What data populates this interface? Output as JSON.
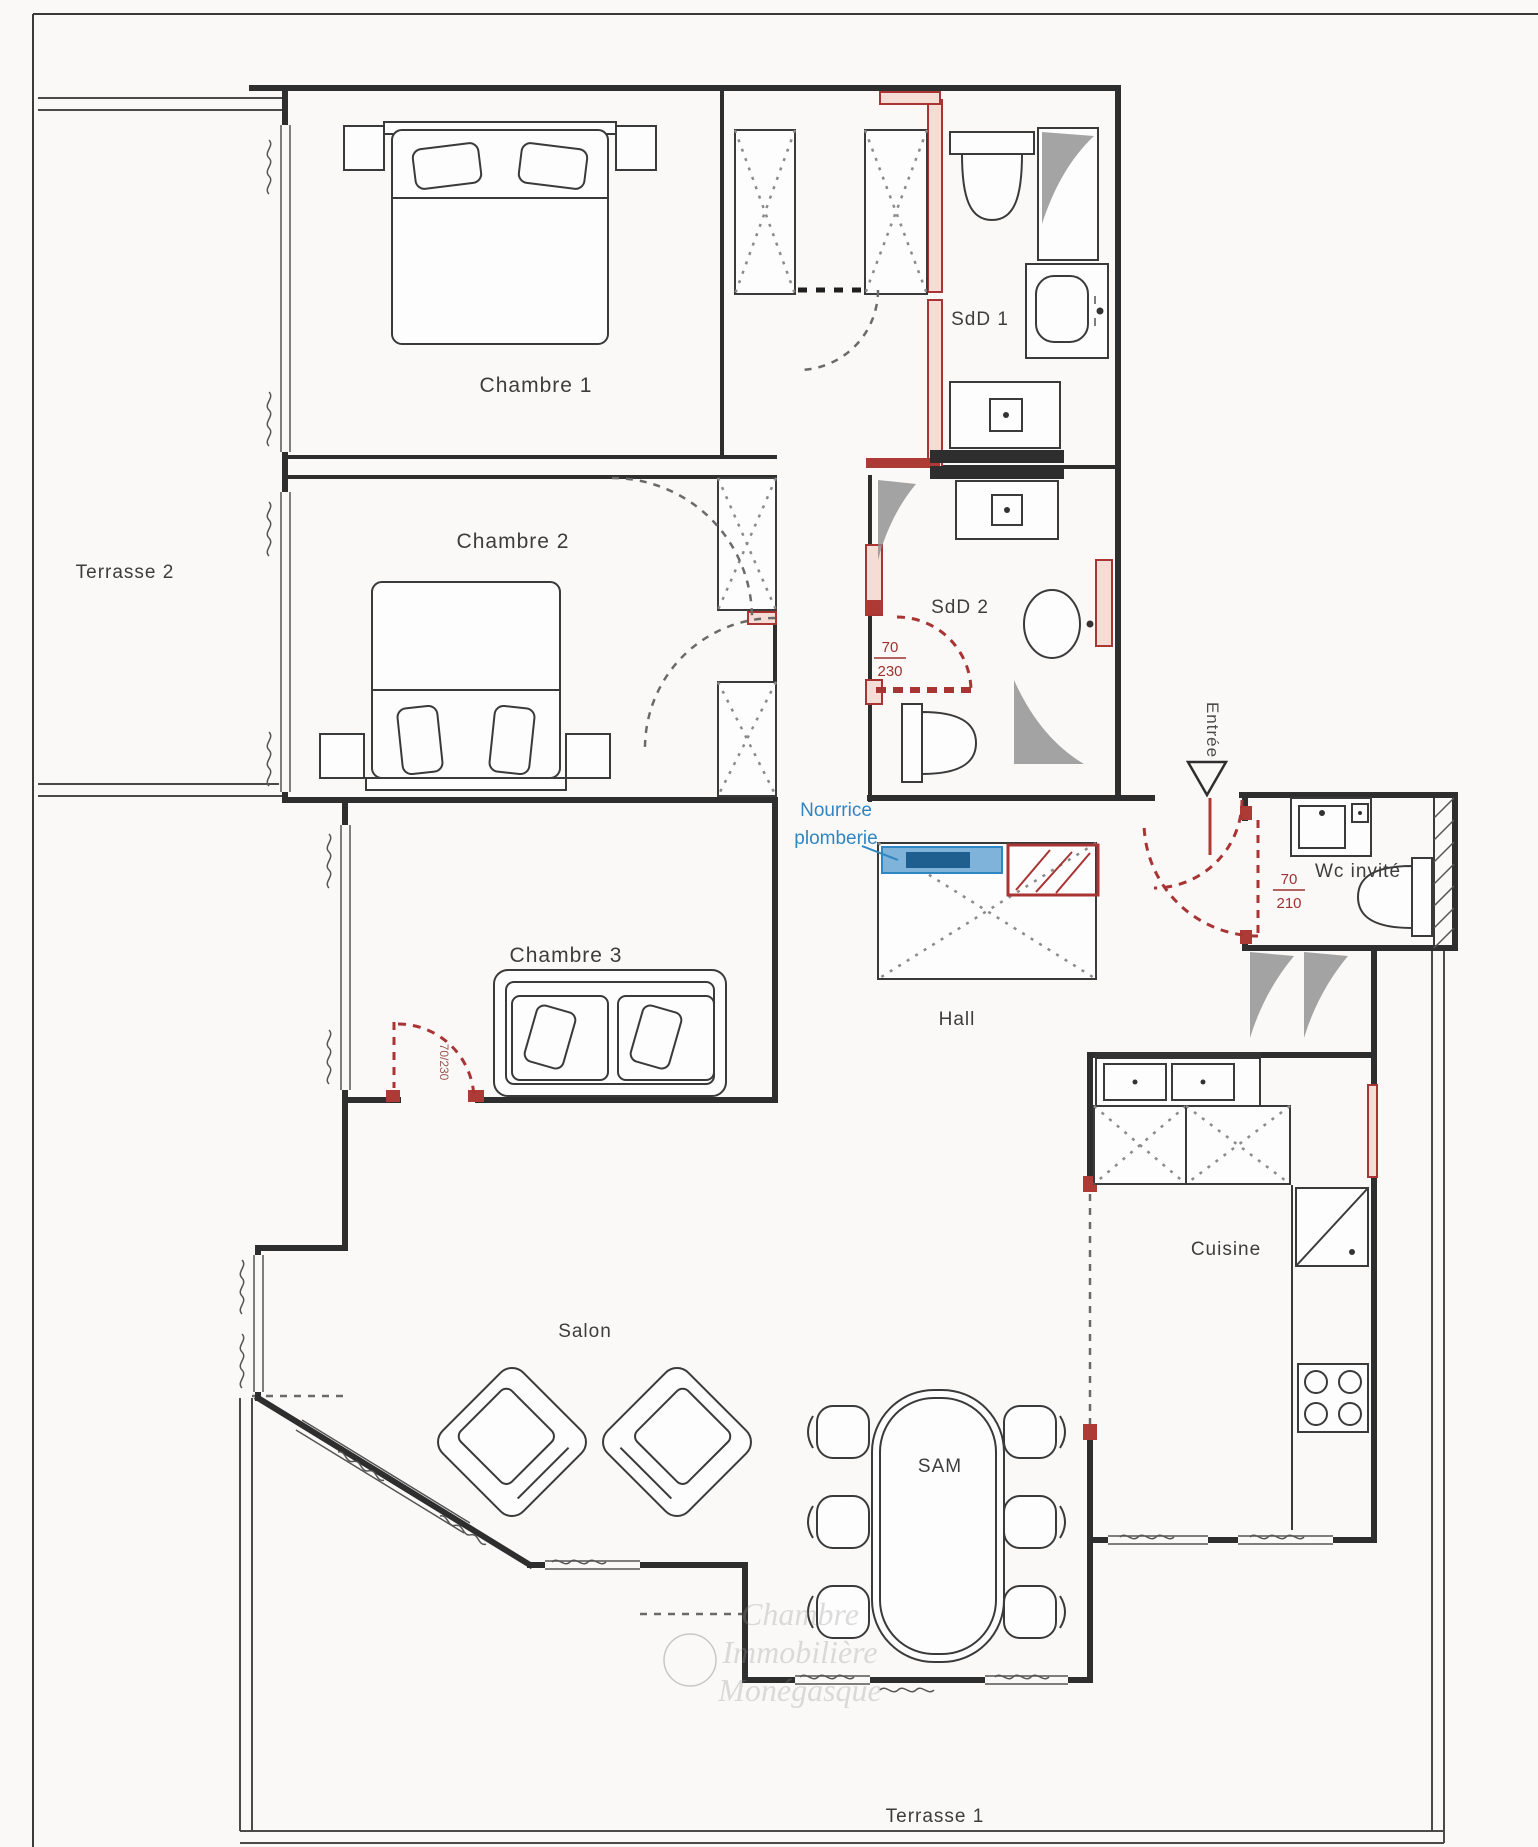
{
  "plan": {
    "rooms": {
      "chambre1": "Chambre 1",
      "chambre2": "Chambre 2",
      "chambre3": "Chambre 3",
      "salon": "Salon",
      "hall": "Hall",
      "sam": "SAM",
      "cuisine": "Cuisine",
      "sdd1": "SdD 1",
      "sdd2": "SdD 2",
      "wc_invite": "Wc invité",
      "terrasse1": "Terrasse 1",
      "terrasse2": "Terrasse 2",
      "entree": "Entrée"
    },
    "dims": {
      "sdd2_door_num": "70",
      "sdd2_door_den": "230",
      "wc_door_num": "70",
      "wc_door_den": "210",
      "ch3_door": "70/230"
    },
    "notes": {
      "plumbing1": "Nourrice",
      "plumbing2": "plomberie"
    },
    "watermark": {
      "l1": "Chambre",
      "l2": "Immobilière",
      "l3": "Monégasque"
    },
    "colors": {
      "wall": "#2e2e2e",
      "red": "#a83434",
      "blue": "#2f86c2"
    }
  }
}
